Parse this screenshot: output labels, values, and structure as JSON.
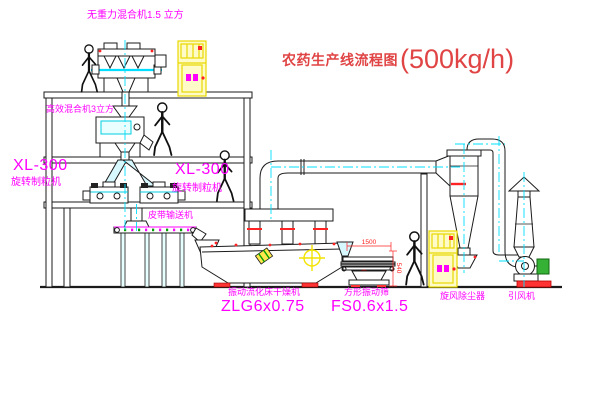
{
  "title": {
    "text_cn": "农药生产线流程图",
    "capacity": "(500kg/h)"
  },
  "labels": {
    "gravityless_mixer": "无重力混合机1.5 立方",
    "high_efficiency_mixer": "高效混合机3立方",
    "granulator_left_model": "XL-300",
    "granulator_left_name": "旋转制粒机",
    "granulator_center_model": "XL-300",
    "granulator_center_name": "旋转制粒机",
    "belt_conveyor": "皮带输送机",
    "fluid_bed_dryer_name": "振动流化床干燥机",
    "fluid_bed_dryer_model": "ZLG6x0.75",
    "vibrating_screen_name": "方形振动筛",
    "vibrating_screen_model": "FS0.6x1.5",
    "cyclone_dust_collector": "旋风除尘器",
    "induced_draft_fan": "引风机"
  },
  "dimensions": {
    "screen_length": "1500",
    "screen_height": "540"
  },
  "colors": {
    "label_magenta": "#ff00ff",
    "title_red": "#e04444",
    "centerline_cyan": "#00dfff",
    "equipment_yellow": "#f2e300",
    "flange_red": "#ff2222",
    "motor_green": "#35b135",
    "line_black": "#1b1b1b"
  }
}
